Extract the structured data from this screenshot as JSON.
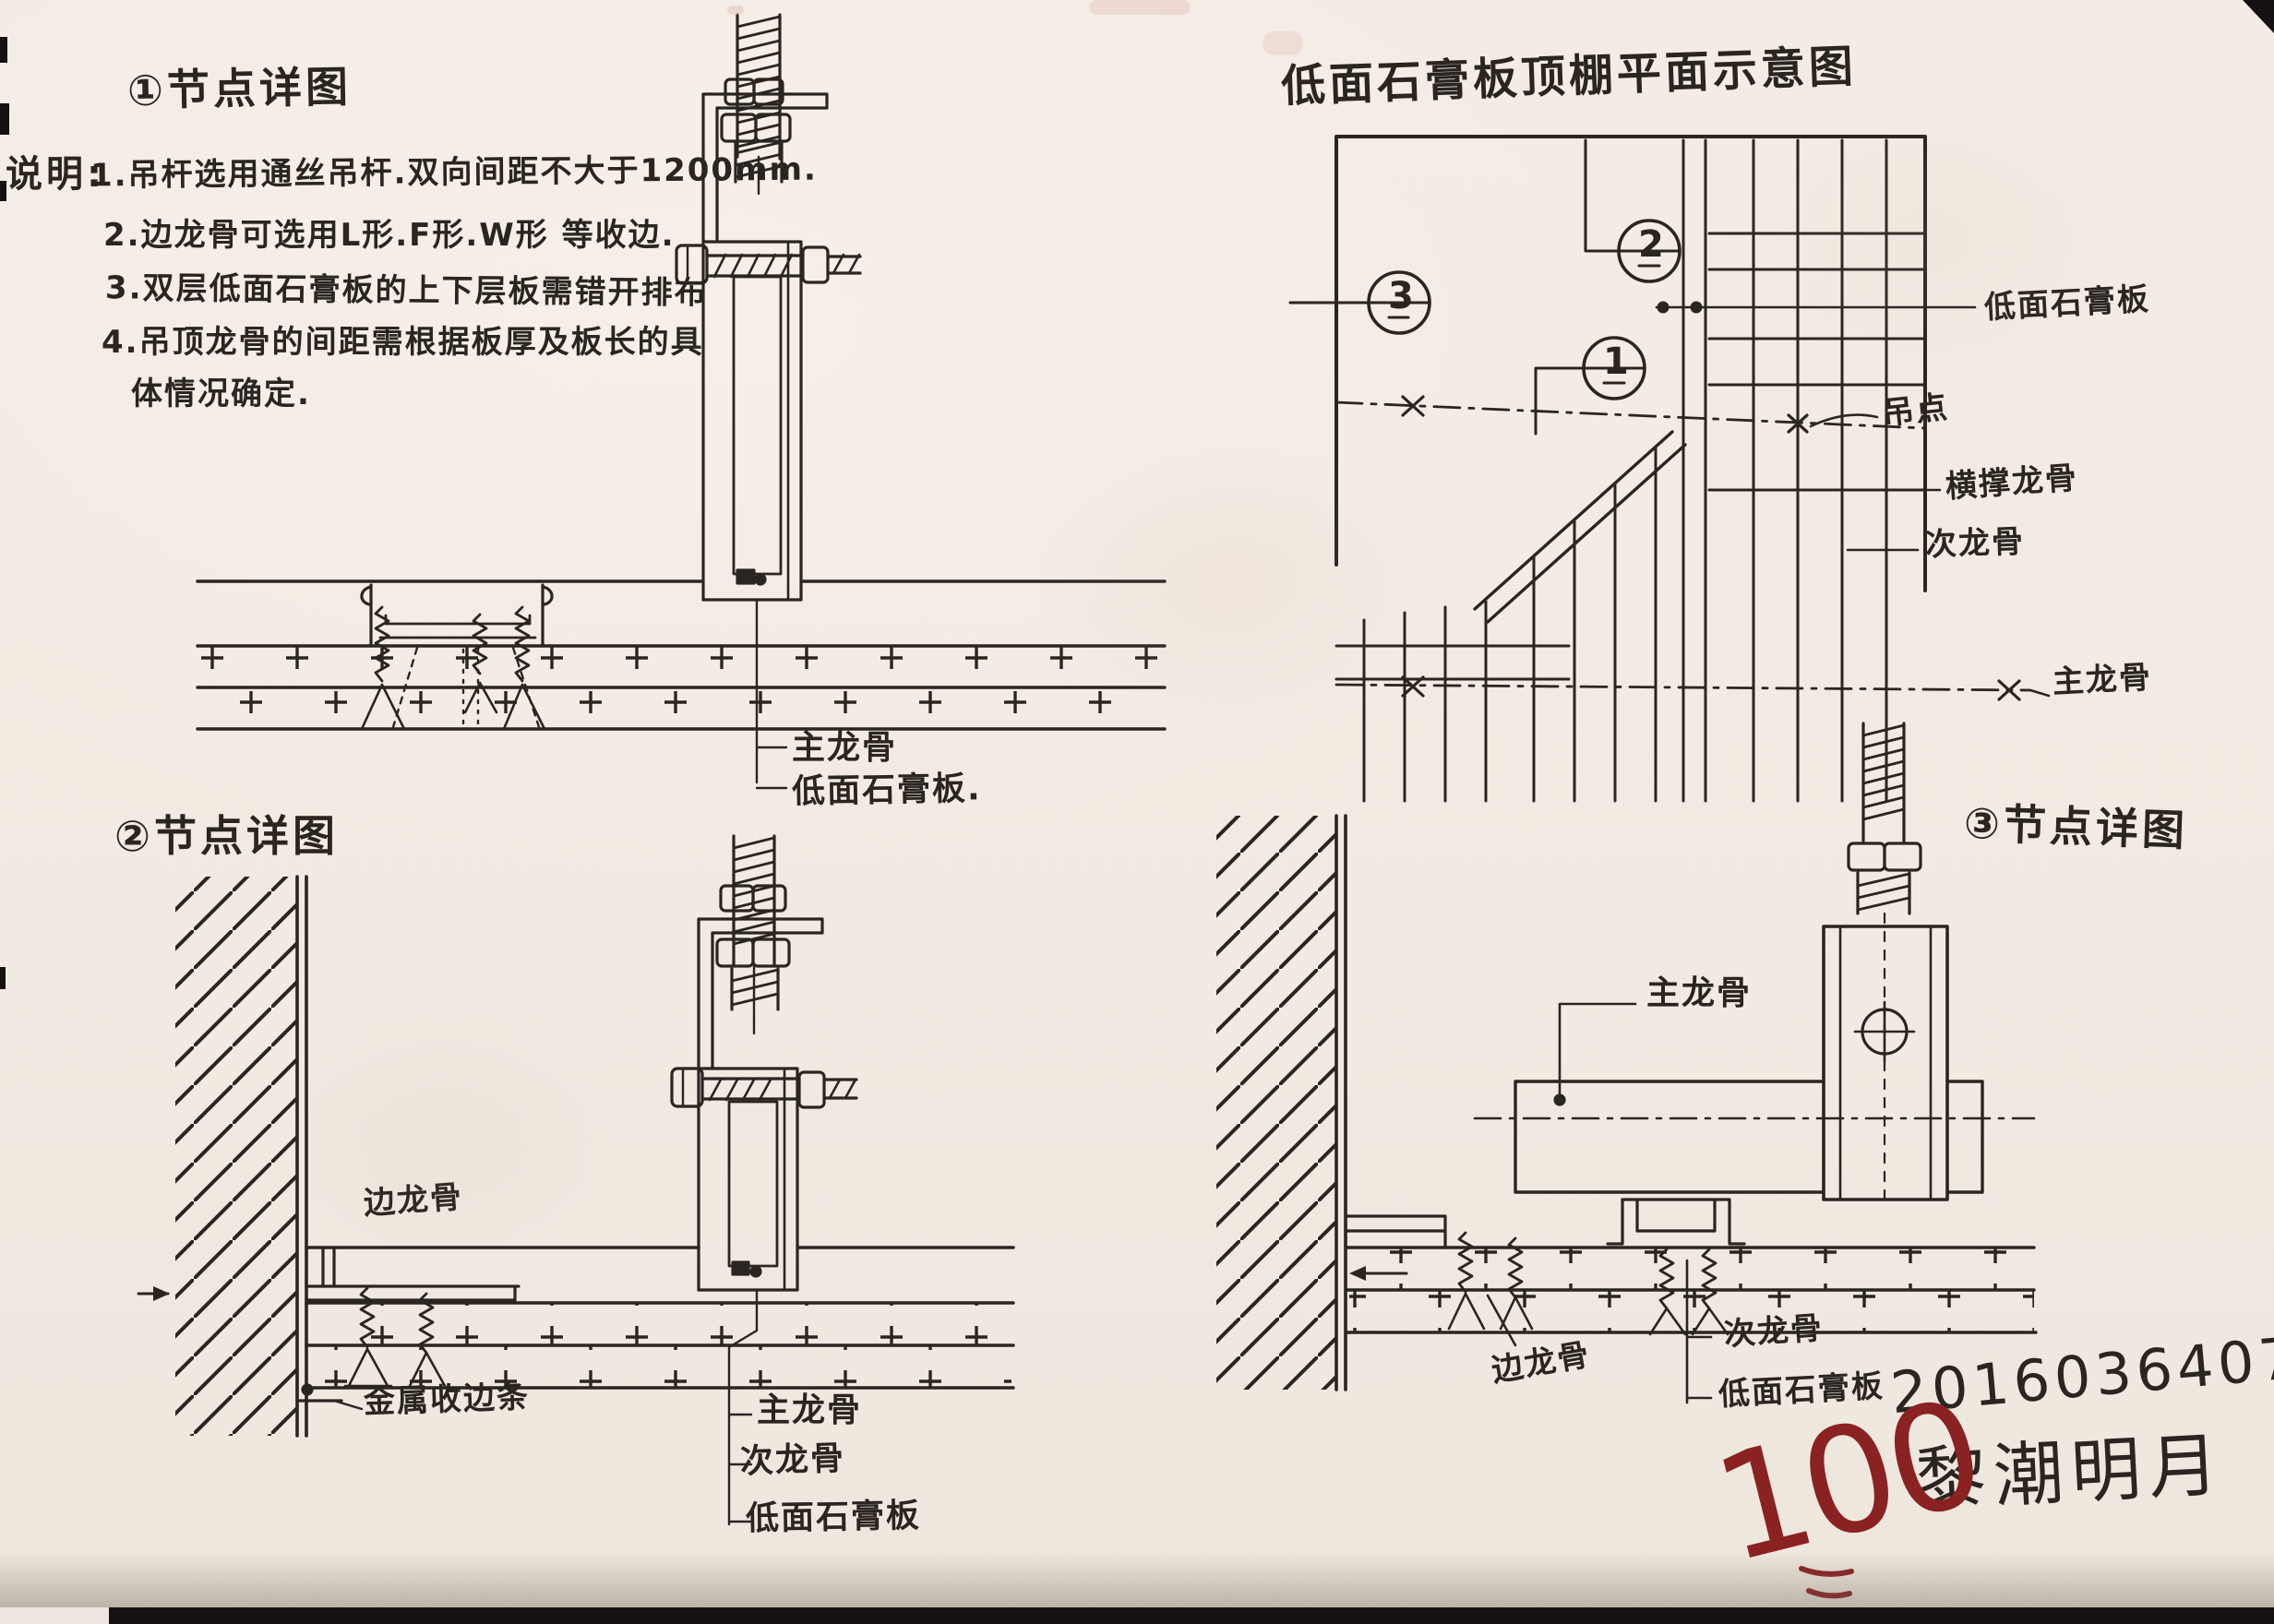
{
  "paper": {
    "ink": "#2b2522",
    "red": "#8b2222",
    "background": "#f4eee6"
  },
  "detail1": {
    "title": "①节点详图",
    "notes_heading": "说明:",
    "notes": [
      "1.吊杆选用通丝吊杆.双向间距不大于1200mm.",
      "2.边龙骨可选用L形.F形.W形 等收边.",
      "3.双层低面石膏板的上下层板需错开排布",
      "4.吊顶龙骨的间距需根据板厚及板长的具",
      "体情况确定."
    ],
    "callout_main_runner": "主龙骨",
    "callout_board": "低面石膏板."
  },
  "plan": {
    "title": "低面石膏板顶棚平面示意图",
    "bubble_1": "1",
    "bubble_2": "2",
    "bubble_3": "3",
    "label_board": "低面石膏板",
    "label_hang_point": "吊点",
    "label_cross_brace": "横撑龙骨",
    "label_secondary_runner": "次龙骨",
    "label_main_runner": "主龙骨"
  },
  "detail2": {
    "title": "②节点详图",
    "label_edge_runner": "边龙骨",
    "label_metal_trim": "金属收边条",
    "label_main_runner": "主龙骨",
    "label_secondary_runner": "次龙骨",
    "label_board": "低面石膏板"
  },
  "detail3": {
    "title": "③节点详图",
    "label_main_runner": "主龙骨",
    "label_edge_runner": "边龙骨",
    "label_secondary_runner": "次龙骨",
    "label_board": "低面石膏板"
  },
  "grading": {
    "score": "100",
    "student_id": "2016036407",
    "student_name": "黎潮明月"
  }
}
